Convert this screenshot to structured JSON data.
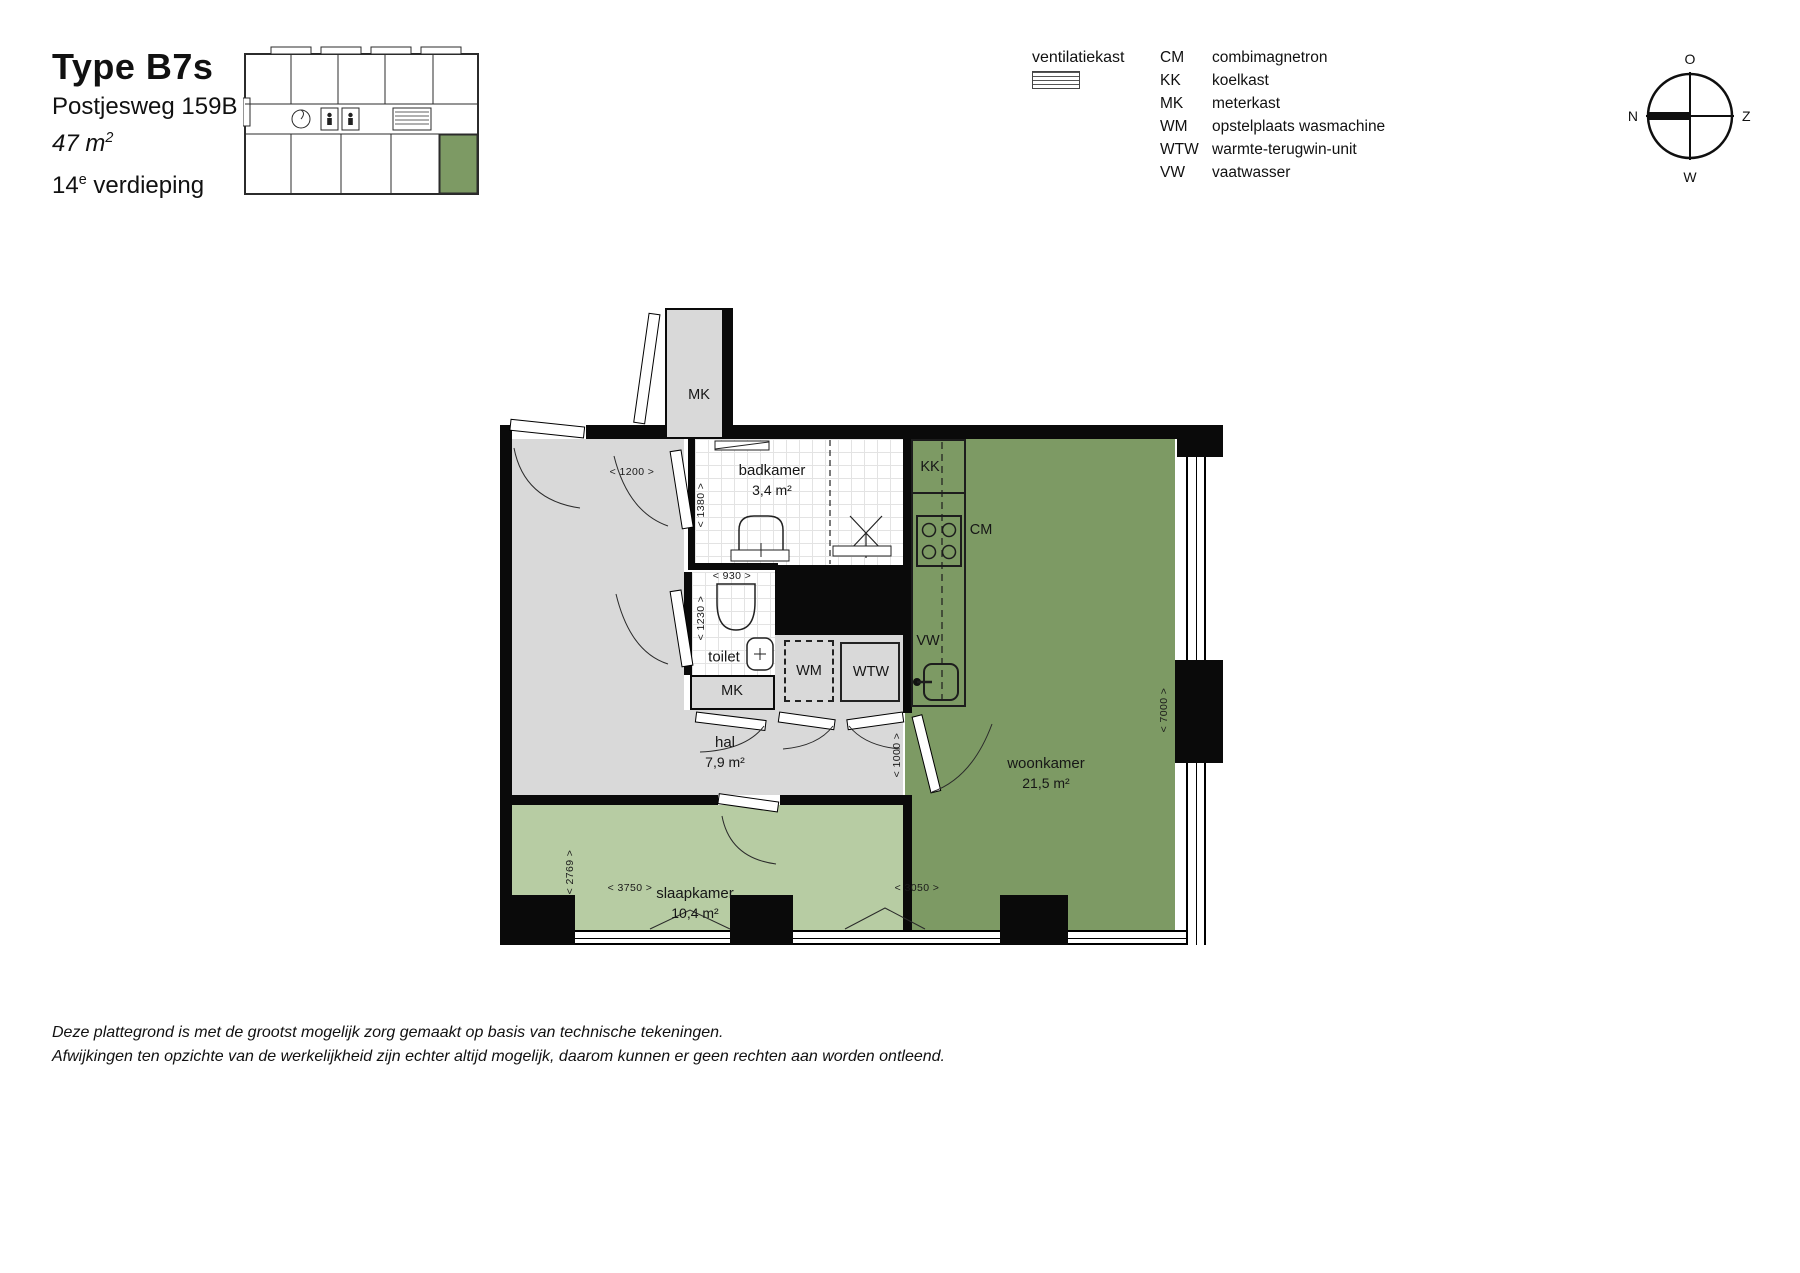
{
  "header": {
    "title": "Type B7s",
    "address": "Postjesweg 159B",
    "area_value": "47 m",
    "area_sup": "2",
    "floor_value": "14",
    "floor_sup": "e",
    "floor_label": " verdieping"
  },
  "legend": {
    "ventilation": "ventilatiekast",
    "items": [
      {
        "abbr": "CM",
        "label": "combimagnetron"
      },
      {
        "abbr": "KK",
        "label": "koelkast"
      },
      {
        "abbr": "MK",
        "label": "meterkast"
      },
      {
        "abbr": "WM",
        "label": "opstelplaats wasmachine"
      },
      {
        "abbr": "WTW",
        "label": "warmte-terugwin-unit"
      },
      {
        "abbr": "VW",
        "label": "vaatwasser"
      }
    ]
  },
  "compass": {
    "top": "O",
    "right": "Z",
    "bottom": "W",
    "left": "N"
  },
  "rooms": {
    "badkamer": {
      "name": "badkamer",
      "area": "3,4 m²"
    },
    "toilet": {
      "name": "toilet"
    },
    "hal": {
      "name": "hal",
      "area": "7,9 m²"
    },
    "slaapkamer": {
      "name": "slaapkamer",
      "area": "10,4 m²"
    },
    "woonkamer": {
      "name": "woonkamer",
      "area": "21,5 m²"
    }
  },
  "appliances": {
    "mk_top": "MK",
    "mk_hal": "MK",
    "wm": "WM",
    "wtw": "WTW",
    "kk": "KK",
    "cm": "CM",
    "vw": "VW"
  },
  "dimensions": {
    "entry": "< 1200 >",
    "badkamer_depth": "< 1380 >",
    "toilet_width": "< 930 >",
    "toilet_depth": "< 1230 >",
    "hal_passage": "< 1000 >",
    "slaapkamer_depth": "< 2769 >",
    "slaapkamer_width": "< 3750 >",
    "woonkamer_width": "< 3050 >",
    "woonkamer_depth": "< 7000 >"
  },
  "footer": {
    "line1": "Deze plattegrond is met de grootst mogelijk zorg gemaakt op basis van technische tekeningen.",
    "line2": "Afwijkingen ten opzichte van de werkelijkheid zijn echter altijd mogelijk, daarom kunnen er geen rechten aan worden ontleend."
  },
  "colors": {
    "accent_green": "#7d9a64",
    "light_green": "#b7cca3",
    "floor_gray": "#d9d9d9"
  }
}
